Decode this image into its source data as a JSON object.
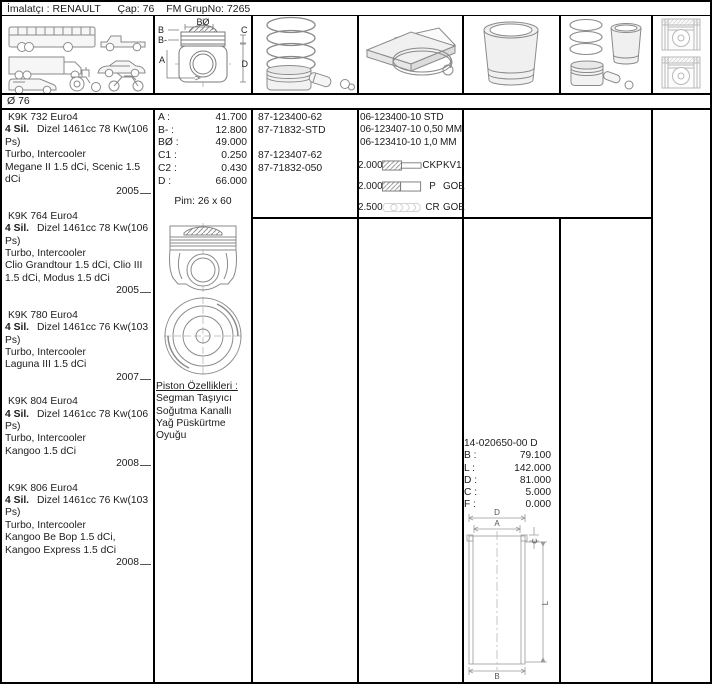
{
  "header": {
    "manufacturer_label": "İmalatçı :",
    "manufacturer": "RENAULT",
    "bore_label": "Çap:",
    "bore": "76",
    "group_label": "FM GrupNo:",
    "group": "7265"
  },
  "bore_label": "Ø 76",
  "image_row": {
    "icons": [
      "vehicle-types-icon",
      "piston-dimensions-icon",
      "ring-set-icon",
      "ring-packaging-icon",
      "cylinder-liner-icon",
      "piston-liner-kit-icon",
      "piston-in-cylinder-icon"
    ],
    "piston_diagram_labels": {
      "b1": "B",
      "b2": "B-",
      "bo": "BØ",
      "c": "C",
      "a": "A",
      "d": "D"
    }
  },
  "engines": [
    {
      "code": "K9K 732 Euro4",
      "cylinders": "4 Sil.",
      "engine": "Dizel 1461cc 78 Kw(106 Ps)",
      "aspiration": "Turbo, Intercooler",
      "models": "Megane II 1.5 dCi, Scenic 1.5 dCi",
      "year": "2005"
    },
    {
      "code": "K9K 764 Euro4",
      "cylinders": "4 Sil.",
      "engine": "Dizel 1461cc 78 Kw(106 Ps)",
      "aspiration": "Turbo, Intercooler",
      "models": "Clio Grandtour 1.5 dCi, Clio III 1.5 dCi, Modus 1.5 dCi",
      "year": "2005"
    },
    {
      "code": "K9K 780 Euro4",
      "cylinders": "4 Sil.",
      "engine": "Dizel 1461cc 76 Kw(103 Ps)",
      "aspiration": "Turbo, Intercooler",
      "models": "Laguna III 1.5 dCi",
      "year": "2007"
    },
    {
      "code": "K9K 804 Euro4",
      "cylinders": "4 Sil.",
      "engine": "Dizel 1461cc 78 Kw(106 Ps)",
      "aspiration": "Turbo, Intercooler",
      "models": "Kangoo 1.5 dCi",
      "year": "2008"
    },
    {
      "code": "K9K 806 Euro4",
      "cylinders": "4 Sil.",
      "engine": "Dizel 1461cc 76 Kw(103 Ps)",
      "aspiration": "Turbo, Intercooler",
      "models": "Kangoo Be Bop 1.5 dCi, Kangoo Express 1.5 dCi",
      "year": "2008"
    }
  ],
  "dimensions": {
    "rows": [
      {
        "label": "A :",
        "value": "41.700"
      },
      {
        "label": "B- :",
        "value": "12.800"
      },
      {
        "label": "BØ :",
        "value": "49.000"
      },
      {
        "label": "C1 :",
        "value": "0.250"
      },
      {
        "label": "C2 :",
        "value": "0.430"
      },
      {
        "label": "D :",
        "value": "66.000"
      }
    ],
    "pin": "Pim: 26 x 60"
  },
  "piston_numbers": {
    "rows": [
      "87-123400-62",
      "87-71832-STD",
      "",
      "87-123407-62",
      "87-71832-050"
    ]
  },
  "ring_sets": {
    "rows": [
      "06-123400-10 STD",
      "06-123407-10 0,50 MM",
      "06-123410-10 1,0 MM"
    ]
  },
  "ring_specs": [
    {
      "size": "2.000",
      "profile": "keystone",
      "type": "CKP",
      "brand": "KV1"
    },
    {
      "size": "2.000",
      "profile": "rect",
      "type": "P",
      "brand": "GOE"
    },
    {
      "size": "2.500",
      "profile": "oil",
      "type": "CR",
      "brand": "GOE"
    }
  ],
  "piston_features": {
    "title": "Piston Özellikleri :",
    "lines": [
      "Segman Taşıyıcı",
      "Soğutma Kanallı",
      "Yağ Püskürtme",
      "Oyuğu"
    ]
  },
  "liner": {
    "part_no": "14-020650-00 D",
    "rows": [
      {
        "label": "B :",
        "value": "79.100"
      },
      {
        "label": "L :",
        "value": "142.000"
      },
      {
        "label": "D :",
        "value": "81.000"
      },
      {
        "label": "C :",
        "value": "5.000"
      },
      {
        "label": "F :",
        "value": "0.000"
      }
    ],
    "diagram_labels": {
      "d": "D",
      "a": "A",
      "c": "C",
      "l": "L",
      "b": "B"
    }
  },
  "colors": {
    "border": "#000000",
    "line_art": "#8a8a8a",
    "text": "#1c1c1c"
  }
}
